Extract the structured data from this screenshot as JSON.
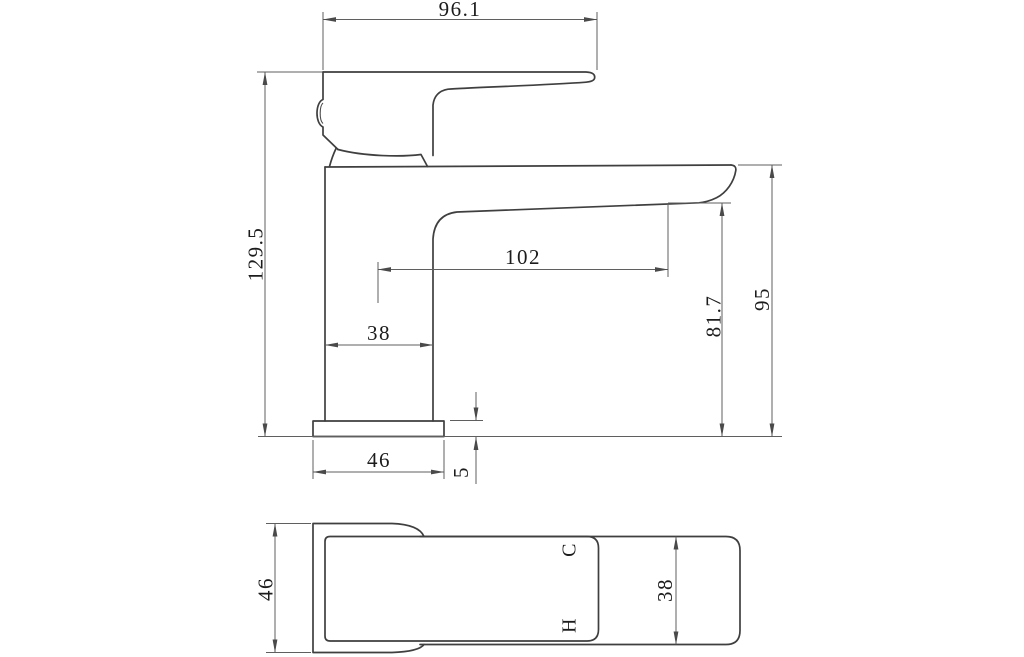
{
  "drawing_type": "faucet-dimension-drawing",
  "colors": {
    "object_line": "#3f3f3f",
    "dimension_line": "#5f5f5f",
    "text": "#1c1c1c",
    "background": "#ffffff"
  },
  "side_view": {
    "handle_length": "96.1",
    "overall_height": "129.5",
    "spout_reach": "102",
    "body_width": "38",
    "base_width": "46",
    "base_plate_height": "5",
    "outlet_height": "81.7",
    "spout_top_height": "95"
  },
  "top_view": {
    "base_depth": "46",
    "spout_width": "38",
    "cold_label": "C",
    "hot_label": "H"
  }
}
